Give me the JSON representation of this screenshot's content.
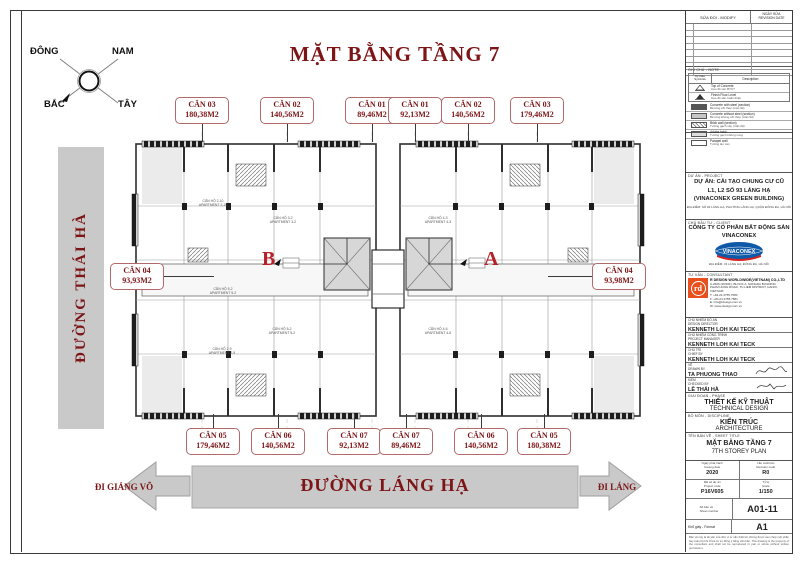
{
  "sheet": {
    "title": "MẶT BẰNG TẦNG 7"
  },
  "compass": {
    "top_left": "ĐÔNG",
    "top_right": "NAM",
    "bottom_left": "BẮC",
    "bottom_right": "TÂY"
  },
  "streets": {
    "left": "ĐƯỜNG THÁI HÀ",
    "bottom": "ĐƯỜNG LÁNG HẠ",
    "arrow_left": "ĐI GIẢNG VÕ",
    "arrow_right": "ĐI LÁNG"
  },
  "marks": {
    "b": "B",
    "a": "A"
  },
  "units": {
    "top": [
      {
        "name": "CĂN 03",
        "area": "180,38M2"
      },
      {
        "name": "CĂN 02",
        "area": "140,56M2"
      },
      {
        "name": "CĂN 01",
        "area": "89,46M2"
      },
      {
        "name": "CĂN 01",
        "area": "92,13M2"
      },
      {
        "name": "CĂN 02",
        "area": "140,56M2"
      },
      {
        "name": "CĂN 03",
        "area": "179,46M2"
      }
    ],
    "bottom": [
      {
        "name": "CĂN 05",
        "area": "179,46M2"
      },
      {
        "name": "CĂN 06",
        "area": "140,56M2"
      },
      {
        "name": "CĂN 07",
        "area": "92,13M2"
      },
      {
        "name": "CĂN 07",
        "area": "89,46M2"
      },
      {
        "name": "CĂN 06",
        "area": "140,56M2"
      },
      {
        "name": "CĂN 05",
        "area": "180,38M2"
      }
    ],
    "left": {
      "name": "CĂN 04",
      "area": "93,93M2"
    },
    "right": {
      "name": "CĂN 04",
      "area": "93,98M2"
    }
  },
  "plan": {
    "units": [
      {
        "vi": "CĂN HỘ 2-10",
        "en": "APARTMENT 2-10"
      },
      {
        "vi": "CĂN HỘ 3-2",
        "en": "APARTMENT 3-2"
      },
      {
        "vi": "CĂN HỘ 5-2",
        "en": "APARTMENT 5-2"
      },
      {
        "vi": "CĂN HỘ 2-9",
        "en": "APARTMENT 2-9"
      },
      {
        "vi": "CĂN HỘ 5-2",
        "en": "APARTMENT 5-2"
      },
      {
        "vi": "CĂN HỘ 4-3",
        "en": "APARTMENT 4-3"
      },
      {
        "vi": "CĂN HỘ 4-6",
        "en": "APARTMENT 4-6"
      }
    ]
  },
  "tb": {
    "revision": {
      "modify": "SỬA ĐỔI - MODIFY",
      "date": "NGÀY SỬA\nREVISION DATE"
    },
    "notes": {
      "header": "GHI CHÚ - NOTE",
      "symbols": "Ký hiệu\nSymbols",
      "description": "Description",
      "rows": [
        {
          "en": "Top of Concrete",
          "vi": "Cao độ sàn BTCT"
        },
        {
          "en": "Finish Floor Level",
          "vi": "Cao độ sàn hoàn thiện"
        },
        {
          "en": "Concrete with steel (section)",
          "vi": "Bê tông cốt thép (mặt cắt)"
        },
        {
          "en": "Concrete without steel (section)",
          "vi": "Bê tông không cốt thép (mặt cắt)"
        },
        {
          "en": "Brick wall (section)",
          "vi": "Tường gạch xây (mặt cắt)"
        },
        {
          "en": "Adobe brick",
          "vi": "Tường gạch không nung"
        },
        {
          "en": "Parapet wall",
          "vi": "Tường lan can"
        }
      ]
    },
    "project": {
      "header": "DỰ ÁN - PROJECT",
      "l1": "DỰ ÁN: CẢI TẠO CHUNG CƯ CŨ",
      "l2": "L1, L2 SỐ 93 LÁNG HẠ",
      "l3": "(VINACONEX GREEN BUILDING)",
      "addr": "ĐỊA ĐIỂM: SỐ 93 LÁNG HẠ, PHƯỜNG LÁNG HẠ, QUẬN ĐỐNG ĐA, HÀ NỘI"
    },
    "client": {
      "header": "CHỦ ĐẦU TƯ - CLIENT",
      "n1": "CÔNG TY CỔ PHẦN BẤT ĐỘNG SẢN",
      "n2": "VINACONEX",
      "logo": "VINACONEX",
      "addr": "ĐỊA ĐIỂM: 34 LÁNG HẠ, ĐỐNG ĐA, HÀ NỘI"
    },
    "consultant": {
      "header": "TƯ VẤN - CONSULTANT",
      "logo": "rd",
      "name": "R DESIGN WORLDWIDE(VIETNAM) CO.,LTD",
      "a1": "A-2606 (26/36F), BLOCK A, SONGDA BUILDING",
      "a2": "PHAM HUNG ROAD, TU LIEM DISTRICT, HANOI, VIETNAM",
      "t": "T:  +84.24.3755.7580",
      "f": "F:  +84.24.3755.7581",
      "e": "E:  info@rdesign.com.vn",
      "w": "W:  www.rdesign.com.vn"
    },
    "personnel": [
      {
        "role": "CHỦ NHIỆM ĐỒ ÁN\nDESIGN DIRECTOR",
        "name": "KENNETH LOH KAI TECK"
      },
      {
        "role": "CHỦ NHIỆM CÔNG TRÌNH\nPROJECT MANAGER",
        "name": "KENNETH LOH KAI TECK"
      },
      {
        "role": "CHỦ TRÌ\nCHIEF BY",
        "name": "KENNETH LOH KAI TECK"
      },
      {
        "role": "VẼ\nDRAWN BY",
        "name": "TA PHUONG THAO"
      },
      {
        "role": "KIỂM\nCHECKED BY",
        "name": "LÊ THÁI HÀ"
      }
    ],
    "phase": {
      "header": "GIAI ĐOẠN - PHASE",
      "vi": "THIẾT KẾ KỸ THUẬT",
      "en": "TECHNICAL DESIGN"
    },
    "discipline": {
      "header": "BỘ MÔN - DISCIPLINE",
      "vi": "KIẾN TRÚC",
      "en": "ARCHITECTURE"
    },
    "sheet_title": {
      "header": "TÊN BẢN VẼ - SHEET TITLE",
      "vi": "MẶT BẰNG TẦNG 7",
      "en": "7TH STOREY PLAN"
    },
    "meta": {
      "issue_label": "Ngày phát hành\nIssuing date",
      "issue": "2020",
      "rev_label": "Lần xuất bản\nRevision code",
      "rev": "R0",
      "code_label": "Mã số dự án\nProject code",
      "code": "P16V605",
      "scale_label": "Tỷ lệ\nScale",
      "scale": "1/150",
      "sheetno_label": "Số bản vẽ\nSheet number",
      "sheetno": "A01-11",
      "format_label": "Khổ giấy - Format",
      "format": "A1"
    },
    "disclaimer": "Bản vẽ này là tài sản của đơn vị tư vấn thiết kế, không được sao chép một phần hay toàn bộ khi chưa có sự đồng ý bằng văn bản. This drawing is the property of the consultant and shall not be reproduced in part or whole without written permission."
  }
}
